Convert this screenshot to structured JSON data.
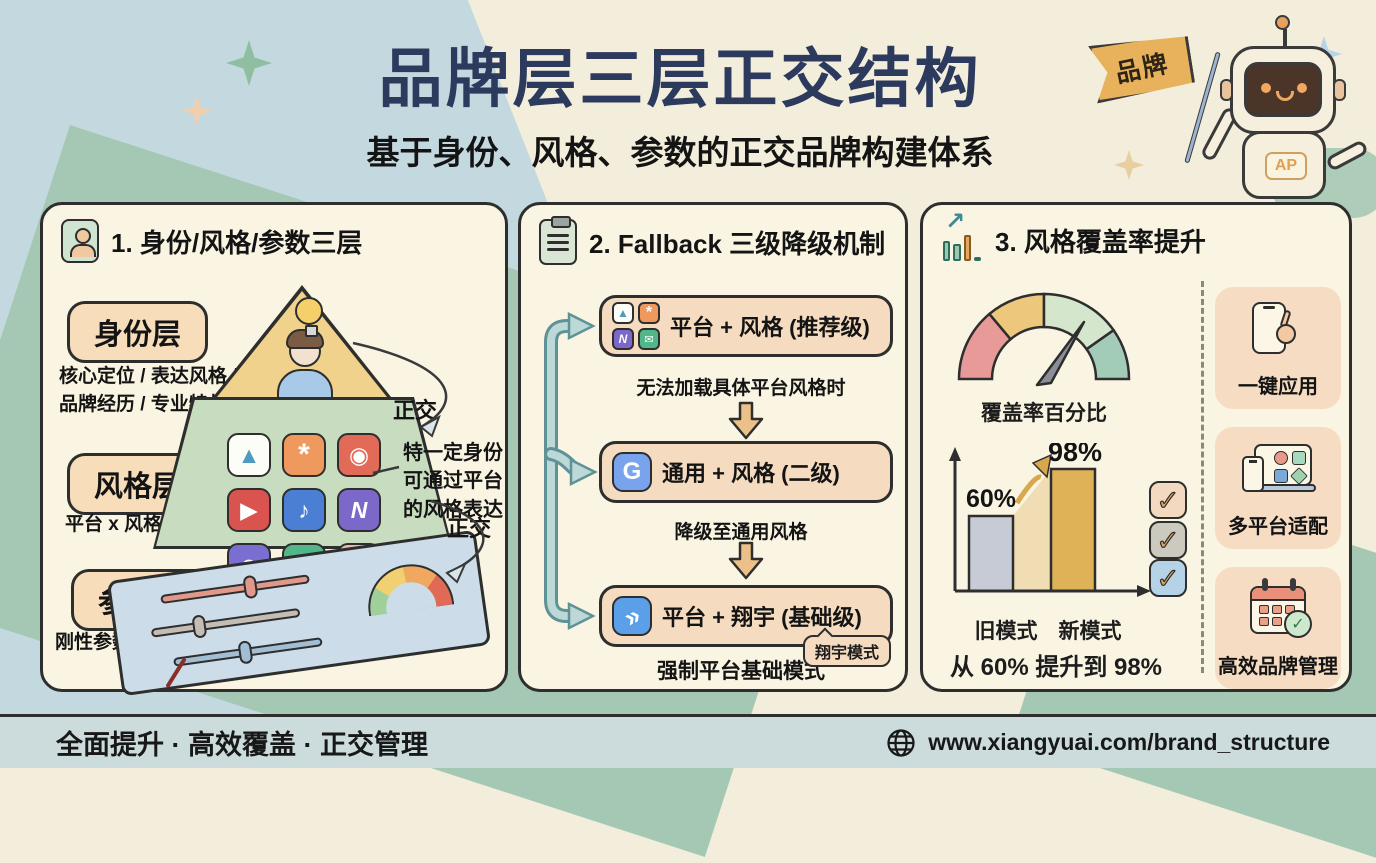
{
  "title": "品牌层三层正交结构",
  "subtitle": "基于身份、风格、参数的正交品牌构建体系",
  "mascot": {
    "flag_label": "品牌",
    "chest_badge": "AP"
  },
  "panels": {
    "identity": {
      "heading": "1. 身份/风格/参数三层",
      "layers": [
        {
          "name": "身份层",
          "desc": "核心定位 / 表达风格 /\n品牌经历 / 专业特长"
        },
        {
          "name": "风格层",
          "desc": "平台 x 风格矩阵"
        },
        {
          "name": "参数层",
          "desc": "刚性参数 + 浮动参数"
        }
      ],
      "orthogonal_label_top": "正交",
      "orthogonal_label_bottom": "正交",
      "side_note": "特一定身份\n可通过平台\n的风格表达"
    },
    "fallback": {
      "heading": "2. Fallback 三级降级机制",
      "steps": [
        {
          "label": "平台 + 风格 (推荐级)",
          "caption": "无法加载具体平台风格时"
        },
        {
          "label": "通用 + 风格 (二级)",
          "caption": "降级至通用风格"
        },
        {
          "label": "平台 + 翔宇 (基础级)",
          "caption": "强制平台基础模式",
          "tag": "翔宇模式"
        }
      ]
    },
    "coverage": {
      "heading": "3. 风格覆盖率提升",
      "gauge_label": "覆盖率百分比",
      "caption": "从 60% 提升到 98%",
      "benefits": [
        "一键应用",
        "多平台适配",
        "高效品牌管理"
      ]
    }
  },
  "chart_data": {
    "type": "bar",
    "categories": [
      "旧模式",
      "新模式"
    ],
    "values": [
      60,
      98
    ],
    "value_labels": [
      "60%",
      "98%"
    ],
    "title": "覆盖率百分比",
    "caption": "从 60% 提升到 98%",
    "ylim": [
      0,
      100
    ],
    "legend": "none",
    "bar_colors": [
      "#c6cbd5",
      "#dfb257"
    ]
  },
  "icons": {
    "grid_glyphs": [
      "▲",
      "*",
      "◉",
      "▶",
      "♪",
      "N",
      "☻",
      "✉",
      "T"
    ],
    "mini_grid_glyphs": [
      "▲",
      "*",
      "N",
      "✉"
    ],
    "generic_icon_glyph": "G",
    "xiangyu_icon_glyph": "»",
    "check_glyph": "✓",
    "growth_arrow_glyph": "↗"
  },
  "colors": {
    "title_navy": "#2c3a5e",
    "panel_bg": "#faf5e2",
    "pill_peach": "#f8ddbb",
    "pyramid_gold": "#f0d28c",
    "style_green": "#c8ddc0",
    "param_blue": "#ccdde9",
    "pipeline_teal": "#bcd8d6",
    "footer_blue": "#ccdcdd"
  },
  "footer": {
    "slogan": "全面提升 · 高效覆盖 · 正交管理",
    "url": "www.xiangyuai.com/brand_structure"
  }
}
